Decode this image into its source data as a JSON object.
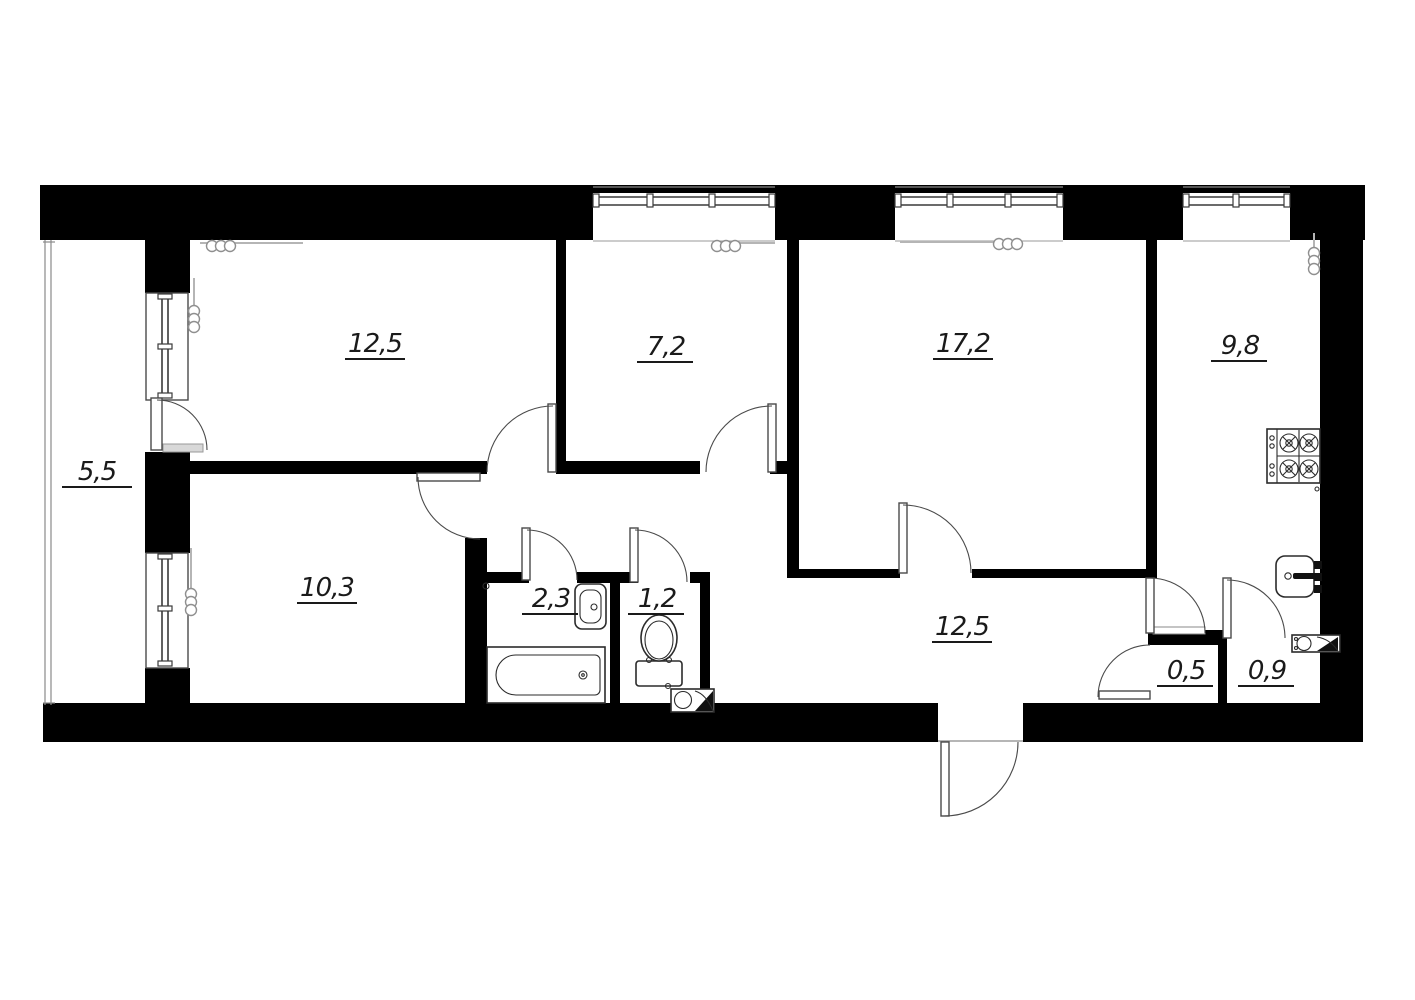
{
  "title": "apartment-floor-plan",
  "colors": {
    "wall": "#000000",
    "background": "#ffffff",
    "door_line": "#4a4a4a",
    "fixture_line": "#2b2b2b"
  },
  "rooms": [
    {
      "name": "balcony",
      "area": "5,5"
    },
    {
      "name": "bedroom",
      "area": "12,5"
    },
    {
      "name": "room-small",
      "area": "7,2"
    },
    {
      "name": "living-room",
      "area": "17,2"
    },
    {
      "name": "kitchen",
      "area": "9,8"
    },
    {
      "name": "bedroom-2",
      "area": "10,3"
    },
    {
      "name": "bathroom",
      "area": "2,3"
    },
    {
      "name": "toilet",
      "area": "1,2"
    },
    {
      "name": "hallway",
      "area": "12,5"
    },
    {
      "name": "storage-small",
      "area": "0,5"
    },
    {
      "name": "storage",
      "area": "0,9"
    }
  ],
  "fixtures": [
    "bathtub",
    "wash-basin",
    "toilet-bowl",
    "gas-stove",
    "kitchen-sink",
    "radiator",
    "vent-duct",
    "entrance-door",
    "window",
    "balcony-glazing"
  ]
}
